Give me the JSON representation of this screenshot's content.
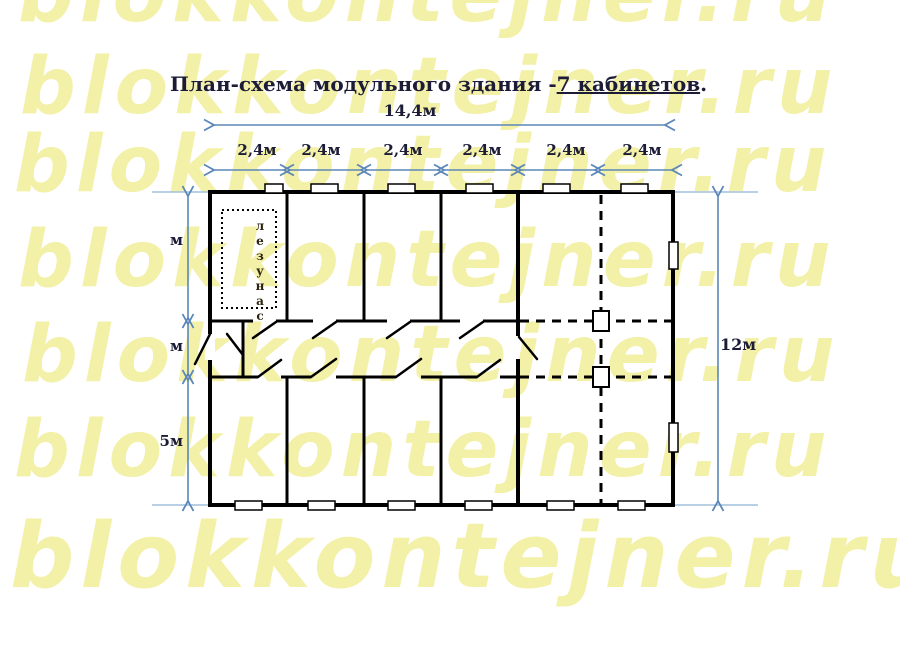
{
  "watermark": {
    "text": "blokkontejner.ru"
  },
  "title": {
    "prefix": "План-схема модульного здания -",
    "underlined": "7 кабинетов",
    "suffix": "."
  },
  "dimensions": {
    "total_width": "14,4м",
    "module_widths": [
      "2,4м",
      "2,4м",
      "2,4м",
      "2,4м",
      "2,4м",
      "2,4м"
    ],
    "left_side_labels": [
      "м",
      "м",
      "5м"
    ],
    "right_height": "12м"
  },
  "rooms": {
    "bathroom_label": "санузел"
  },
  "colors": {
    "watermark": "#f3f0a8",
    "text": "#1c1c36",
    "walls": "#000000",
    "dimension_lines": "#5b87b8",
    "extension_lines": "#8fb3d4",
    "bathroom_text": "#2e2410"
  }
}
